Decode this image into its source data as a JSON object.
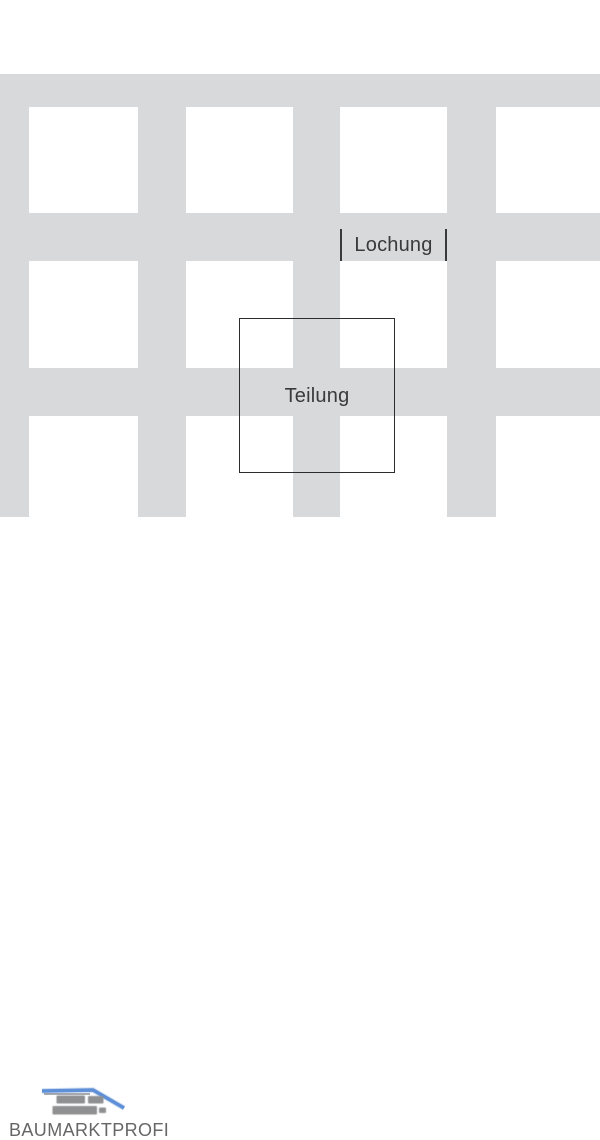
{
  "diagram": {
    "lochung_label": "Lochung",
    "teilung_label": "Teilung"
  },
  "logo": {
    "wordmark": "BAUMARKTPROFI"
  },
  "colors": {
    "panel_gray": "#d8d9da",
    "label_text": "#3a3a3c",
    "dimension_line": "#3a3a3c",
    "teilung_border": "#2b2c2e",
    "logo_blue": "#5e8fd7",
    "logo_blue_light": "#a9c3e8",
    "logo_brick_gray": "#8f9091",
    "logo_roof_shadow": "#6f7680",
    "wordmark_gray": "#666667",
    "background": "#ffffff"
  }
}
